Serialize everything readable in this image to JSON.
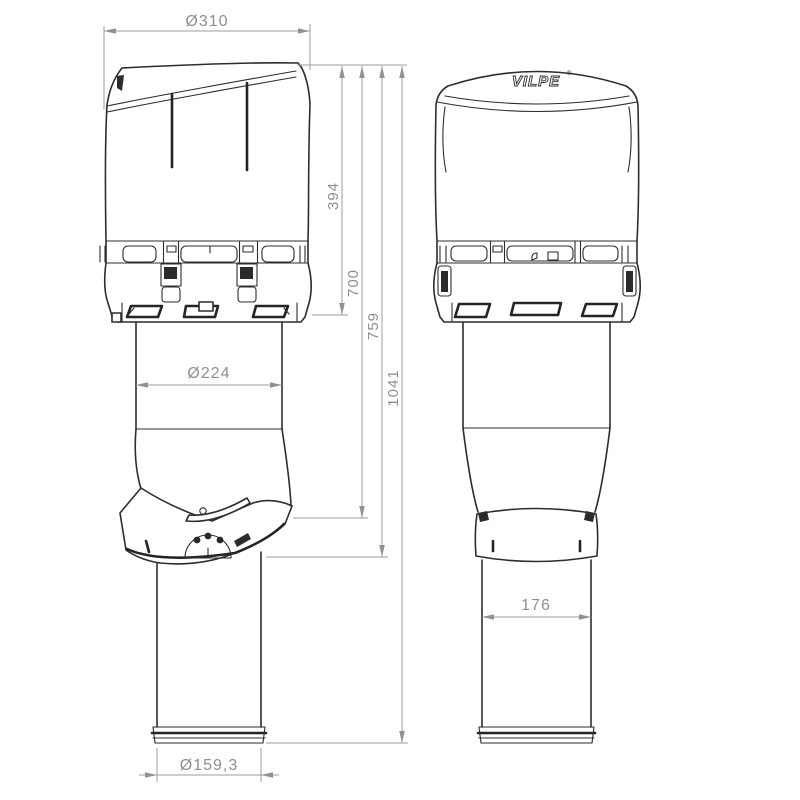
{
  "drawing": {
    "brand": {
      "logo": "VILPE",
      "registered_mark": "®"
    },
    "dimensions": {
      "cap_diameter": "Ø310",
      "cap_height": "394",
      "height_to_deflector_top": "700",
      "height_to_deflector_bottom": "759",
      "total_height": "1041",
      "insulated_pipe_diameter": "Ø224",
      "outlet_pipe_diameter": "Ø159,3",
      "right_pipe_width": "176"
    },
    "colors": {
      "outline": "#2d2d2d",
      "dimension_lines": "#9b9da0",
      "dimension_text": "#8d8f91",
      "background": "#ffffff"
    }
  }
}
